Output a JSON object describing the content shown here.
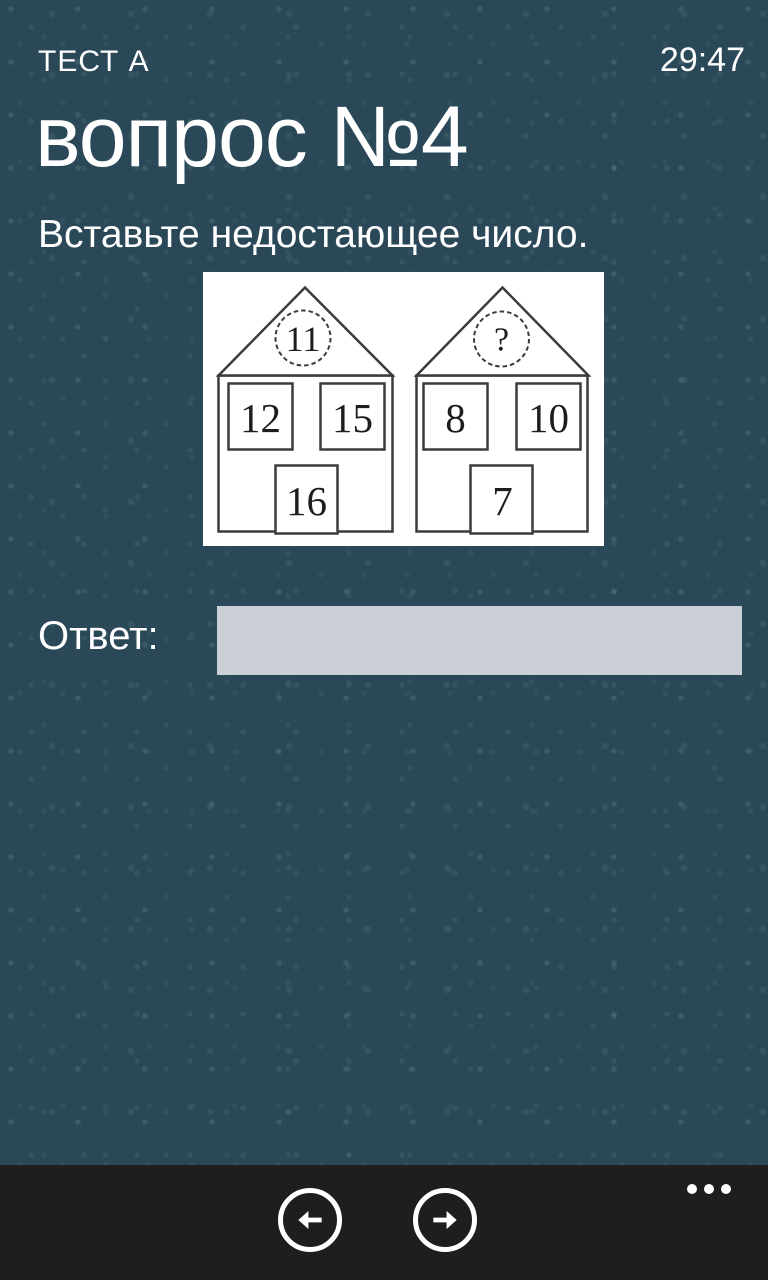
{
  "header": {
    "app_title": "ТЕСТ А",
    "timer": "29:47"
  },
  "page": {
    "title": "вопрос №4",
    "instruction": "Вставьте недостающее число."
  },
  "figure": {
    "description": "two-houses-missing-number-puzzle",
    "houses": [
      {
        "roof": "11",
        "top_left": "12",
        "top_right": "15",
        "bottom": "16"
      },
      {
        "roof": "?",
        "top_left": "8",
        "top_right": "10",
        "bottom": "7"
      }
    ]
  },
  "answer": {
    "label": "Ответ:",
    "value": "",
    "placeholder": ""
  },
  "appbar": {
    "back_icon": "arrow-left",
    "forward_icon": "arrow-right",
    "more_icon": "ellipsis"
  },
  "colors": {
    "background": "#2a4858",
    "appbar_background": "#1e1e1e",
    "input_background": "#c9cfd4",
    "text": "#ffffff",
    "figure_background": "#ffffff",
    "figure_stroke": "#3c3c3c"
  }
}
